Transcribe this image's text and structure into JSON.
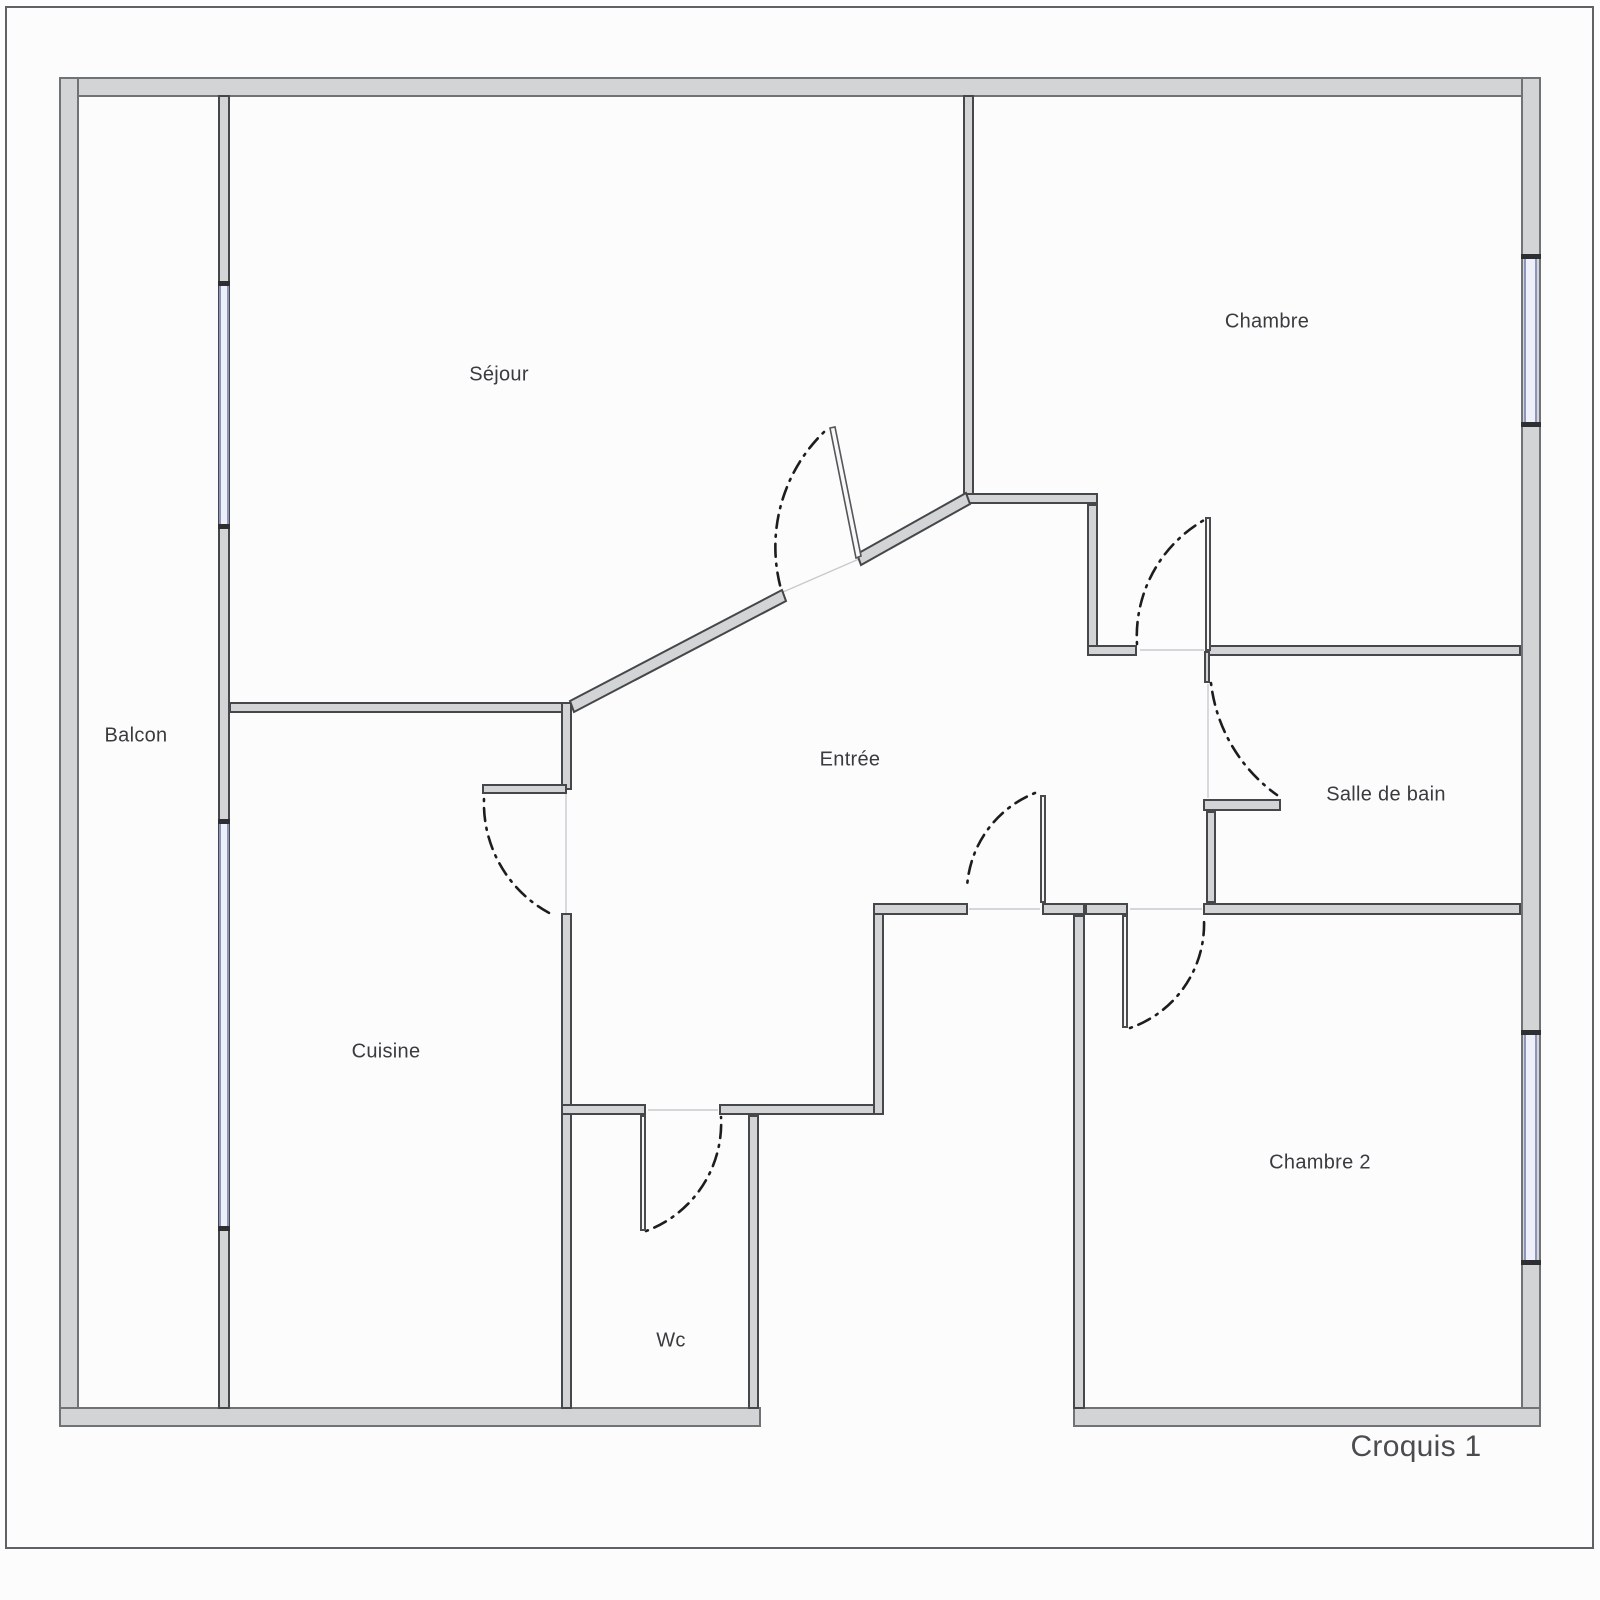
{
  "caption": {
    "text": "Croquis 1"
  },
  "colors": {
    "wall_fill": "#d3d4d6",
    "wall_edge": "#46474b",
    "exterior_edge": "#717276",
    "window_edge": "#8d95bd",
    "window_fill": "#eef0f9",
    "arc_color": "#1d1d1f",
    "label_color": "#3a3b3e",
    "page_border": "#606165"
  },
  "rooms": [
    {
      "id": "sejour",
      "text": "Séjour",
      "x": 499,
      "y": 375
    },
    {
      "id": "chambre",
      "text": "Chambre",
      "x": 1267,
      "y": 322
    },
    {
      "id": "balcon",
      "text": "Balcon",
      "x": 136,
      "y": 736
    },
    {
      "id": "entree",
      "text": "Entrée",
      "x": 850,
      "y": 760
    },
    {
      "id": "salle-de-bain",
      "text": "Salle de bain",
      "x": 1386,
      "y": 795
    },
    {
      "id": "cuisine",
      "text": "Cuisine",
      "x": 386,
      "y": 1052
    },
    {
      "id": "wc",
      "text": "Wc",
      "x": 671,
      "y": 1341
    },
    {
      "id": "chambre-2",
      "text": "Chambre 2",
      "x": 1320,
      "y": 1163
    }
  ],
  "floorplan": {
    "walls": [
      {
        "t": "ext",
        "r": [
          59,
          77,
          1482,
          20
        ]
      },
      {
        "t": "ext",
        "r": [
          59,
          77,
          20,
          1350
        ]
      },
      {
        "t": "ext",
        "r": [
          1521,
          77,
          20,
          1350
        ]
      },
      {
        "t": "ext",
        "r": [
          59,
          1407,
          702,
          20
        ]
      },
      {
        "t": "ext",
        "r": [
          1073,
          1407,
          468,
          20
        ]
      },
      {
        "t": "int",
        "r": [
          218,
          95,
          12,
          1314
        ]
      },
      {
        "t": "int",
        "r": [
          229,
          702,
          343,
          11
        ]
      },
      {
        "t": "int",
        "r": [
          561,
          702,
          11,
          88
        ]
      },
      {
        "t": "int",
        "r": [
          482,
          784,
          85,
          10
        ]
      },
      {
        "t": "int",
        "r": [
          561,
          913,
          11,
          496
        ]
      },
      {
        "t": "int",
        "r": [
          561,
          1104,
          85,
          11
        ]
      },
      {
        "t": "int",
        "r": [
          719,
          1104,
          165,
          11
        ]
      },
      {
        "t": "int",
        "r": [
          748,
          1115,
          11,
          294
        ]
      },
      {
        "t": "int",
        "r": [
          873,
          903,
          11,
          212
        ]
      },
      {
        "t": "int",
        "r": [
          873,
          903,
          95,
          12
        ]
      },
      {
        "t": "int",
        "r": [
          1042,
          903,
          43,
          12
        ]
      },
      {
        "t": "int",
        "r": [
          1073,
          915,
          12,
          494
        ]
      },
      {
        "t": "int",
        "r": [
          1085,
          903,
          43,
          12
        ]
      },
      {
        "t": "int",
        "r": [
          1203,
          903,
          318,
          12
        ]
      },
      {
        "t": "int",
        "r": [
          963,
          95,
          11,
          400
        ]
      },
      {
        "t": "int",
        "r": [
          963,
          493,
          135,
          11
        ]
      },
      {
        "t": "int",
        "r": [
          1087,
          504,
          11,
          147
        ]
      },
      {
        "t": "int",
        "r": [
          1087,
          645,
          50,
          11
        ]
      },
      {
        "t": "int",
        "r": [
          1206,
          645,
          315,
          11
        ]
      },
      {
        "t": "int",
        "r": [
          1204,
          651,
          6,
          32
        ]
      },
      {
        "t": "int",
        "r": [
          1203,
          799,
          78,
          12
        ]
      },
      {
        "t": "int",
        "r": [
          1206,
          811,
          10,
          92
        ]
      }
    ],
    "leaves": [
      {
        "r": [
          1205,
          517,
          6,
          134
        ]
      },
      {
        "r": [
          1122,
          915,
          6,
          113
        ]
      },
      {
        "r": [
          640,
          1115,
          6,
          116
        ]
      },
      {
        "r": [
          1040,
          795,
          6,
          108
        ]
      }
    ],
    "windows": [
      {
        "r": [
          219,
          285,
          10,
          242
        ]
      },
      {
        "r": [
          219,
          823,
          10,
          405
        ]
      },
      {
        "r": [
          1524,
          258,
          13,
          166
        ]
      },
      {
        "r": [
          1524,
          1034,
          13,
          228
        ]
      }
    ],
    "ticks": [
      {
        "r": [
          218,
          281,
          12,
          5
        ]
      },
      {
        "r": [
          218,
          524,
          12,
          5
        ]
      },
      {
        "r": [
          218,
          819,
          12,
          5
        ]
      },
      {
        "r": [
          218,
          1226,
          12,
          5
        ]
      },
      {
        "r": [
          1521,
          254,
          20,
          5
        ]
      },
      {
        "r": [
          1521,
          422,
          20,
          5
        ]
      },
      {
        "r": [
          1521,
          1030,
          20,
          5
        ]
      },
      {
        "r": [
          1521,
          1260,
          20,
          5
        ]
      }
    ],
    "polys": [
      {
        "cls": "wallpoly",
        "points": "570,701 782,590 786,601 574,712"
      },
      {
        "cls": "wallpoly",
        "points": "857,554 966,493 970,504 861,565"
      },
      {
        "cls": "leafpoly",
        "points": "830,428 835,427 861,556 856,558"
      }
    ],
    "arcs": [
      {
        "d": "M 824 432 A 160 160 0 0 0 781 589"
      },
      {
        "d": "M 484 799 A 125 125 0 0 0 551 914"
      },
      {
        "d": "M 1137 644 A 134 134 0 0 1 1206 519"
      },
      {
        "d": "M 1211 683 A 160 160 0 0 0 1277 795"
      },
      {
        "d": "M 1035 793 A 108 108 0 0 0 967 888"
      },
      {
        "d": "M 1130 1028 A 110 110 0 0 0 1204 920"
      },
      {
        "d": "M 646 1231 A 115 115 0 0 0 721 1117"
      }
    ],
    "reflines": [
      {
        "l": [
          783,
          592,
          859,
          559
        ]
      },
      {
        "l": [
          566,
          794,
          566,
          913
        ]
      },
      {
        "l": [
          1140,
          650,
          1204,
          650
        ]
      },
      {
        "l": [
          1130,
          909,
          1202,
          909
        ]
      },
      {
        "l": [
          648,
          1110,
          718,
          1110
        ]
      },
      {
        "l": [
          1208,
          684,
          1208,
          798
        ]
      },
      {
        "l": [
          969,
          909,
          1040,
          909
        ]
      }
    ]
  }
}
